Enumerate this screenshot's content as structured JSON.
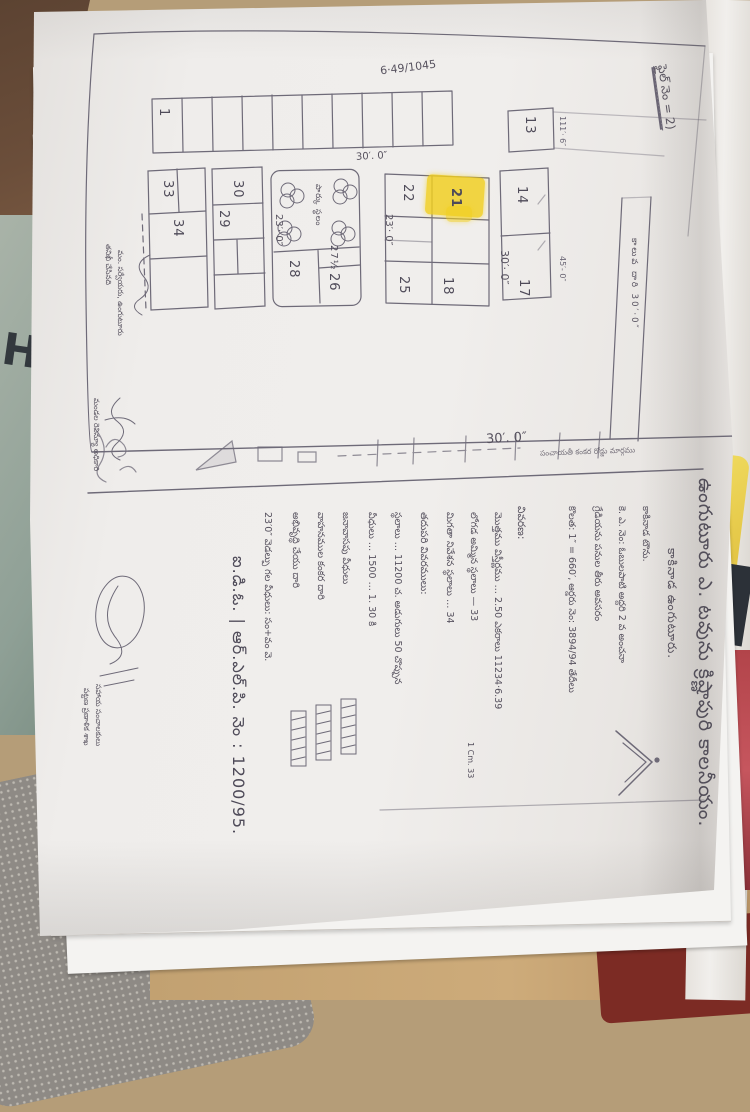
{
  "document": {
    "note_top_right": "ఫైల్ నెం = 2)",
    "survey_number": "6·49/1045",
    "map": {
      "plot_labels": [
        "1",
        "13",
        "14",
        "17",
        "18",
        "21",
        "22",
        "25",
        "26",
        "27½",
        "28",
        "29",
        "30",
        "33",
        "34"
      ],
      "highlighted_plot": "21",
      "road_width_labels": [
        "30′· 0″",
        "23′· 0″",
        "23′· 0″",
        "30′. 0″",
        "30′. 0″"
      ],
      "dimension_labels": [
        "45′- 0″",
        "111′· 6″"
      ],
      "canal_label": "కాలువ దారి 30′·0″",
      "park_label": "పార్కు స్థలం",
      "bottom_road_label": "పంచాయతీ కంకర రోడ్డు మార్గము"
    },
    "title": {
      "line1": "ఉంగుటూరు ఎ. టవును క్రిష్ణాపురి కాలనీయం.",
      "line2": "కాకినాడ ఉంగుటూరు."
    },
    "info_lines": [
      "కాకినాడ టౌను.",
      "కె. ఎ. నెం: ఓబులపాటి అద్దరి 2 వ అంచనా",
      "గ్రేడియను పనుల తీరు అవసరం",
      "కొలత: 1″ = 660′,  ఆర్డరు నెం: 3894/94 తేదీలు",
      "వివరణ:",
      "మొత్తము విస్తీర్ణము …  2.50 ఎకరాలు  11234·6.39",
      "లోగడ అమ్మిన స్థలాలు  —  33",
      "మిగతా నివేశన స్థలాలు  …  34",
      "తదుపరి వివరములు:",
      "స్థలాలు … 11200 చ. అడుగులు 50 చొప్పున",
      "వీధులు … 1500 …   1. 30 కి",
      "జనావాసపు వీధులు",
      "వాహనముల కంకర దారి",
      "అభివృద్ధి చేయు దారి",
      "23′0″ వెడల్పు గల వీధులు: సం+వం   వె."
    ],
    "scale_note": "1 Cm. 33",
    "id_line": "ఐ.డి.ఓ. | ఆర్.ఎల్.పి. నెం : 1200/95.",
    "signatures": [
      "తనిఖీ చేసినది",
      "మం. సర్వేయరు, ఉంగుటూరు",
      "మండల రెవిన్యూ అధికారి",
      "సహాయ సంచాలకులు",
      "పట్టణ ప్రణాళిక శాఖ"
    ]
  },
  "colors": {
    "highlight": "#f2cf1d",
    "pencil": "#5f5b68",
    "paper": "#edebe8"
  }
}
